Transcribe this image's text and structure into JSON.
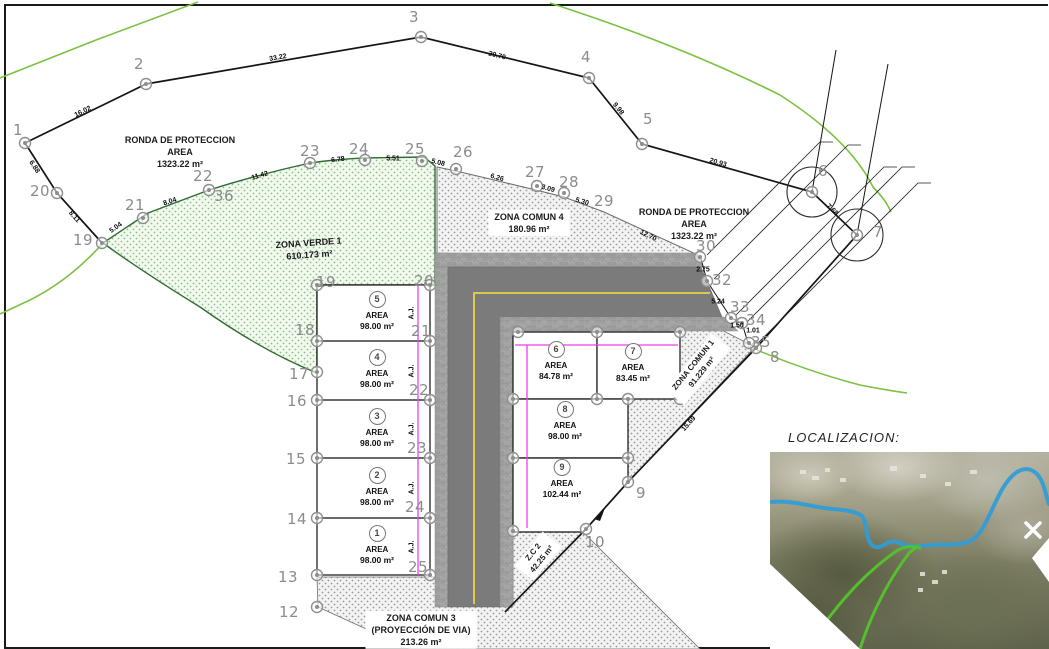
{
  "inset": {
    "title": "LOCALIZACION:"
  },
  "zone_labels": [
    {
      "name": "ronda-proteccion-left",
      "lines": [
        "RONDA DE PROTECCION",
        "AREA",
        "1323.22 m²"
      ],
      "x": 180,
      "y": 152,
      "rot": 0,
      "boxed": false,
      "size": 9
    },
    {
      "name": "zona-verde-1",
      "lines": [
        "ZONA VERDE 1",
        "610.173 m²"
      ],
      "x": 309,
      "y": 249,
      "rot": -4,
      "boxed": false,
      "size": 9
    },
    {
      "name": "zona-comun-4",
      "lines": [
        "ZONA COMUN 4",
        "180.96 m²"
      ],
      "x": 529,
      "y": 223,
      "rot": 0,
      "boxed": true,
      "size": 9
    },
    {
      "name": "ronda-proteccion-right",
      "lines": [
        "RONDA DE PROTECCION",
        "AREA",
        "1323.22 m²"
      ],
      "x": 694,
      "y": 224,
      "rot": 0,
      "boxed": false,
      "size": 9
    },
    {
      "name": "zona-comun-1",
      "lines": [
        "ZONA COMUN 1",
        "91.229 m²"
      ],
      "x": 698,
      "y": 369,
      "rot": -51,
      "boxed": true,
      "size": 8
    },
    {
      "name": "zc-2",
      "lines": [
        "Z.C 2",
        "42.25 m²"
      ],
      "x": 538,
      "y": 556,
      "rot": -51,
      "boxed": true,
      "size": 8
    },
    {
      "name": "zona-comun-3",
      "lines": [
        "ZONA COMUN 3",
        "(PROYECCIÓN DE VIA)",
        "213.26 m²"
      ],
      "x": 421,
      "y": 630,
      "rot": 0,
      "boxed": true,
      "size": 9
    }
  ],
  "lots": [
    {
      "n": "5",
      "x": 377,
      "y": 297,
      "area_word": "AREA",
      "area": "98.00 m²"
    },
    {
      "n": "4",
      "x": 377,
      "y": 355,
      "area_word": "AREA",
      "area": "98.00 m²"
    },
    {
      "n": "3",
      "x": 377,
      "y": 414,
      "area_word": "AREA",
      "area": "98.00 m²"
    },
    {
      "n": "2",
      "x": 377,
      "y": 473,
      "area_word": "AREA",
      "area": "98.00 m²"
    },
    {
      "n": "1",
      "x": 377,
      "y": 531,
      "area_word": "AREA",
      "area": "98.00 m²"
    },
    {
      "n": "6",
      "x": 556,
      "y": 347,
      "area_word": "AREA",
      "area": "84.78 m²"
    },
    {
      "n": "7",
      "x": 633,
      "y": 349,
      "area_word": "AREA",
      "area": "83.45 m²"
    },
    {
      "n": "8",
      "x": 565,
      "y": 407,
      "area_word": "AREA",
      "area": "98.00 m²"
    },
    {
      "n": "9",
      "x": 562,
      "y": 465,
      "area_word": "AREA",
      "area": "102.44 m²"
    }
  ],
  "vertex_labels": [
    [
      "1",
      18,
      130
    ],
    [
      "2",
      139,
      64
    ],
    [
      "3",
      414,
      17
    ],
    [
      "4",
      586,
      57
    ],
    [
      "5",
      648,
      119
    ],
    [
      "6",
      823,
      171
    ],
    [
      "7",
      878,
      232
    ],
    [
      "8",
      775,
      357
    ],
    [
      "9",
      641,
      493
    ],
    [
      "10",
      595,
      542
    ],
    [
      "12",
      289,
      612
    ],
    [
      "13",
      288,
      577
    ],
    [
      "14",
      297,
      519
    ],
    [
      "15",
      296,
      459
    ],
    [
      "16",
      297,
      401
    ],
    [
      "17",
      299,
      374
    ],
    [
      "18",
      305,
      330
    ],
    [
      "19",
      83,
      240
    ],
    [
      "20",
      40,
      191
    ],
    [
      "21",
      135,
      205
    ],
    [
      "22",
      203,
      176
    ],
    [
      "36",
      224,
      196
    ],
    [
      "23",
      310,
      151
    ],
    [
      "24",
      359,
      149
    ],
    [
      "25",
      415,
      149
    ],
    [
      "26",
      463,
      152
    ],
    [
      "27",
      535,
      172
    ],
    [
      "28",
      569,
      182
    ],
    [
      "29",
      604,
      201
    ],
    [
      "30",
      706,
      246
    ],
    [
      "32",
      722,
      280
    ],
    [
      "33",
      740,
      307
    ],
    [
      "34",
      756,
      320
    ],
    [
      "35",
      761,
      342
    ],
    [
      "19",
      326,
      282
    ],
    [
      "20",
      424,
      281
    ],
    [
      "21",
      421,
      331
    ],
    [
      "22",
      419,
      390
    ],
    [
      "23",
      417,
      448
    ],
    [
      "24",
      415,
      507
    ],
    [
      "25",
      418,
      567
    ]
  ],
  "edge_labels": [
    [
      "16.02",
      83,
      112,
      -26
    ],
    [
      "33.22",
      278,
      58,
      -10
    ],
    [
      "20.70",
      497,
      56,
      14
    ],
    [
      "9.98",
      618,
      109,
      51
    ],
    [
      "20.93",
      718,
      163,
      16
    ],
    [
      "7.68",
      832,
      210,
      44
    ],
    [
      "6.88",
      34,
      167,
      57
    ],
    [
      "8.11",
      74,
      217,
      48
    ],
    [
      "5.04",
      116,
      228,
      -35
    ],
    [
      "8.04",
      170,
      202,
      -18
    ],
    [
      "11.42",
      260,
      176,
      -17
    ],
    [
      "6.78",
      338,
      160,
      -6
    ],
    [
      "5.51",
      393,
      159,
      0
    ],
    [
      "5.08",
      438,
      163,
      14
    ],
    [
      "6.26",
      497,
      178,
      15
    ],
    [
      "3.09",
      548,
      189,
      15
    ],
    [
      "5.30",
      582,
      202,
      17
    ],
    [
      "12.70",
      648,
      236,
      26
    ],
    [
      "2.75",
      703,
      270,
      0
    ],
    [
      "5.24",
      718,
      302,
      0
    ],
    [
      "1.50",
      737,
      326,
      0
    ],
    [
      "1.01",
      753,
      331,
      0
    ],
    [
      "15.69",
      689,
      424,
      -48
    ]
  ],
  "aj_labels": {
    "text": "A.J.",
    "x": 412,
    "ys": [
      313,
      371,
      429,
      488,
      547
    ]
  },
  "vertex_markers": [
    [
      25,
      143
    ],
    [
      146,
      84
    ],
    [
      421,
      37
    ],
    [
      589,
      78
    ],
    [
      642,
      144
    ],
    [
      812,
      192
    ],
    [
      857,
      235
    ],
    [
      756,
      348
    ],
    [
      628,
      482
    ],
    [
      586,
      529
    ],
    [
      57,
      193
    ],
    [
      102,
      243
    ],
    [
      143,
      218
    ],
    [
      209,
      190
    ],
    [
      310,
      163
    ],
    [
      365,
      160
    ],
    [
      422,
      161
    ],
    [
      456,
      169
    ],
    [
      537,
      186
    ],
    [
      564,
      193
    ],
    [
      700,
      257
    ],
    [
      707,
      281
    ],
    [
      731,
      318
    ],
    [
      742,
      323
    ],
    [
      749,
      343
    ],
    [
      317,
      285
    ],
    [
      317,
      341
    ],
    [
      317,
      372
    ],
    [
      317,
      400
    ],
    [
      317,
      458
    ],
    [
      317,
      518
    ],
    [
      317,
      575
    ],
    [
      317,
      607
    ],
    [
      430,
      285
    ],
    [
      430,
      341
    ],
    [
      430,
      400
    ],
    [
      430,
      458
    ],
    [
      430,
      518
    ],
    [
      430,
      575
    ],
    [
      518,
      332
    ],
    [
      597,
      332
    ],
    [
      680,
      332
    ],
    [
      513,
      399
    ],
    [
      597,
      399
    ],
    [
      628,
      399
    ],
    [
      680,
      399
    ],
    [
      513,
      458
    ],
    [
      628,
      458
    ],
    [
      513,
      531
    ]
  ],
  "colors": {
    "boundary": "#151515",
    "green_line": "#7cc142",
    "green_zone_edge": "#2f6d33",
    "magenta": "#f23cf2",
    "yellow": "#e7d44a",
    "asphalt": "#7b7b7b",
    "grey_label": "#8c8c8c"
  }
}
